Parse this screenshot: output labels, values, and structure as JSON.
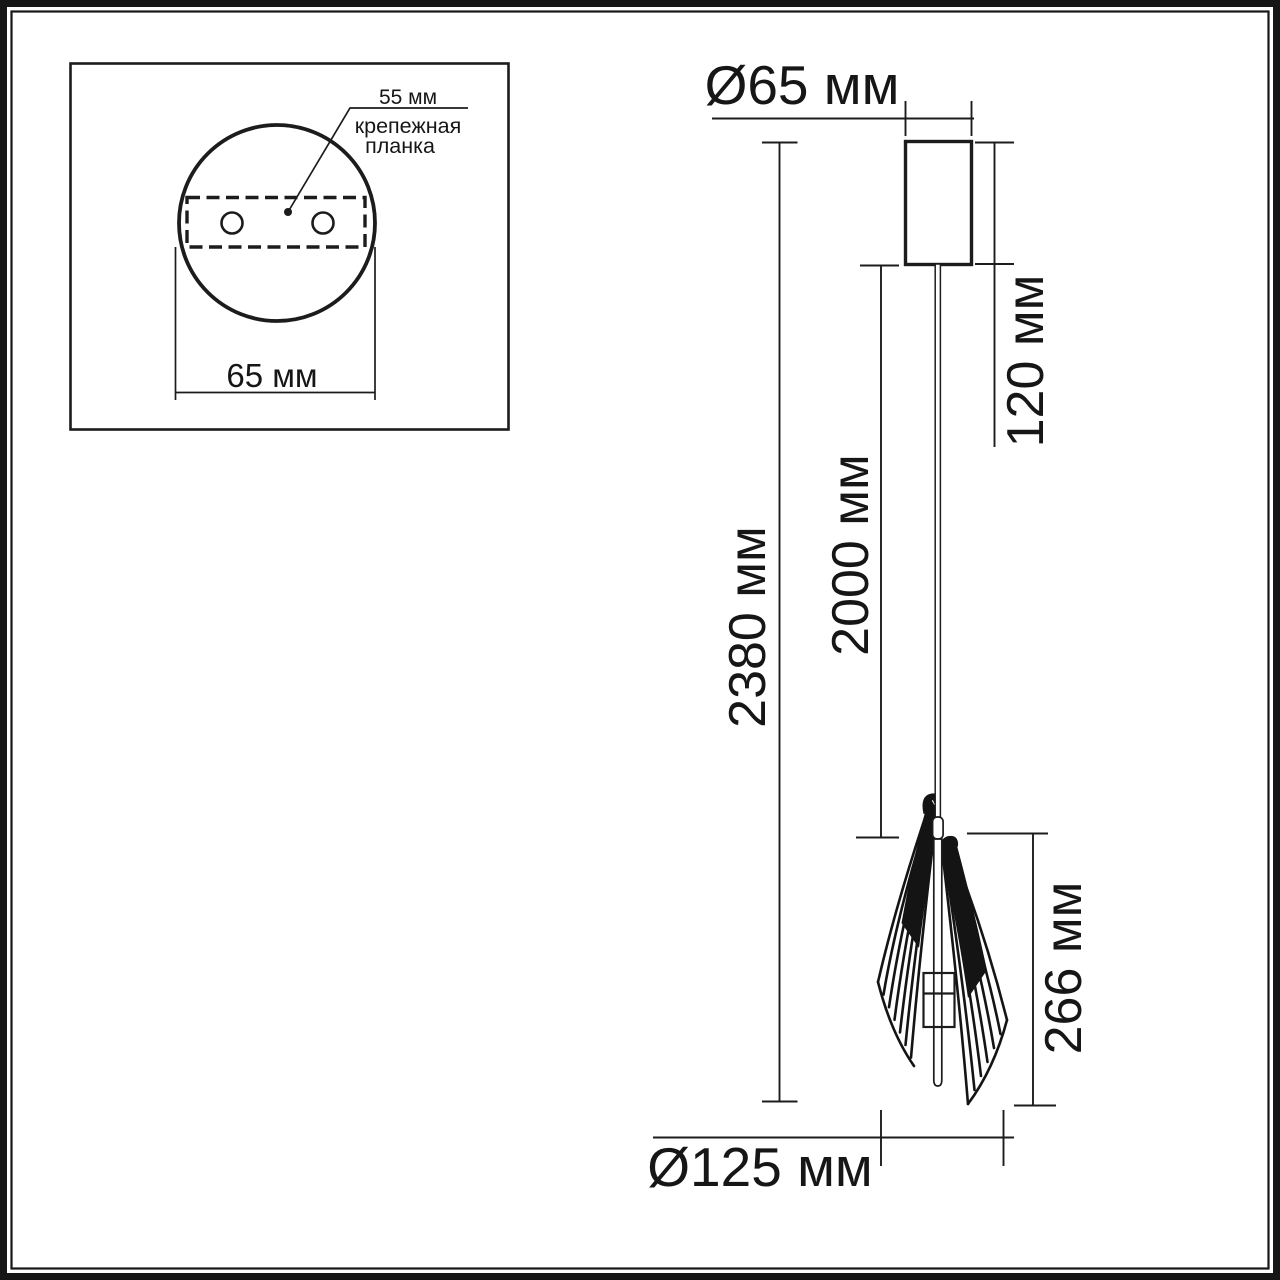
{
  "drawing_type": "pendant-light-dimension-drawing",
  "inset": {
    "dim_spacing": "55 мм",
    "mount_label_line1": "крепежная",
    "mount_label_line2": "планка",
    "dim_width": "65 мм"
  },
  "dimensions": {
    "canopy_diameter": "Ø65 мм",
    "canopy_height": "120 мм",
    "total_height": "2380 мм",
    "cable_length": "2000 мм",
    "shade_height": "266 мм",
    "shade_diameter": "Ø125 мм"
  },
  "colors": {
    "line": "#1c1c1c",
    "background": "#ffffff"
  }
}
